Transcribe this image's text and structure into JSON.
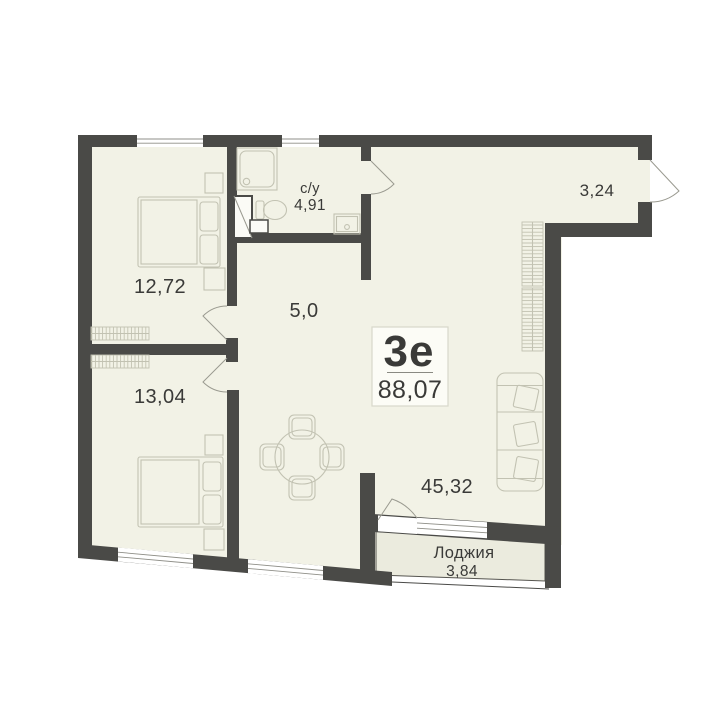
{
  "unit": {
    "type_label": "3е",
    "total_area": "88,07"
  },
  "rooms": {
    "bedroom1": {
      "area": "12,72"
    },
    "bedroom2": {
      "area": "13,04"
    },
    "hallway": {
      "area": "5,0"
    },
    "bathroom": {
      "name": "с/у",
      "area": "4,91"
    },
    "entry": {
      "area": "3,24"
    },
    "living": {
      "area": "45,32"
    },
    "loggia": {
      "name": "Лоджия",
      "area": "3,84"
    }
  },
  "colors": {
    "wall": "#4a4a47",
    "room": "#f2f2e6",
    "loggia": "#ebebde",
    "furniture": "#c2c2b2",
    "outline": "#55544f",
    "text": "#3a3a38",
    "label_box_bg": "#fcfcf6",
    "label_box_border": "#d8d8ca",
    "window_line": "#8f8f88",
    "background": "#ffffff"
  }
}
